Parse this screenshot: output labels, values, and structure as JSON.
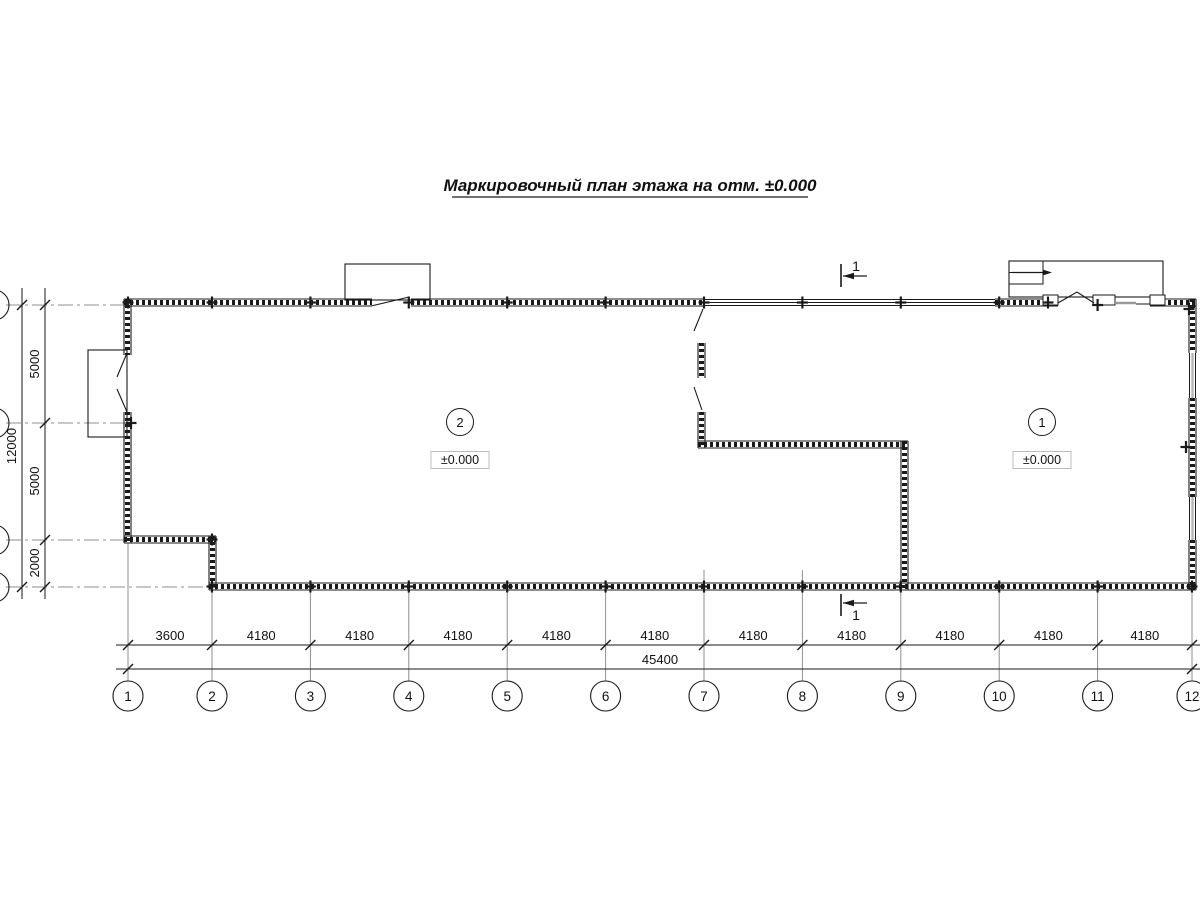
{
  "title": "Маркировочный план этажа на отм. ±0.000",
  "dims": {
    "bottom_segments": [
      "3600",
      "4180",
      "4180",
      "4180",
      "4180",
      "4180",
      "4180",
      "4180",
      "4180",
      "4180",
      "4180"
    ],
    "bottom_total": "45400",
    "left_segments": [
      "5000",
      "5000",
      "2000"
    ],
    "left_total": "12000"
  },
  "axes_bottom": [
    "1",
    "2",
    "3",
    "4",
    "5",
    "6",
    "7",
    "8",
    "9",
    "10",
    "11",
    "12"
  ],
  "rooms": {
    "left": {
      "number": "2",
      "elevation": "±0.000"
    },
    "right": {
      "number": "1",
      "elevation": "±0.000"
    }
  },
  "section": {
    "top_label": "1",
    "bottom_label": "1"
  },
  "colors": {
    "line": "#1a1a1a",
    "muted": "#8f8f8f",
    "elevation_box_border": "#bdbdbd"
  }
}
